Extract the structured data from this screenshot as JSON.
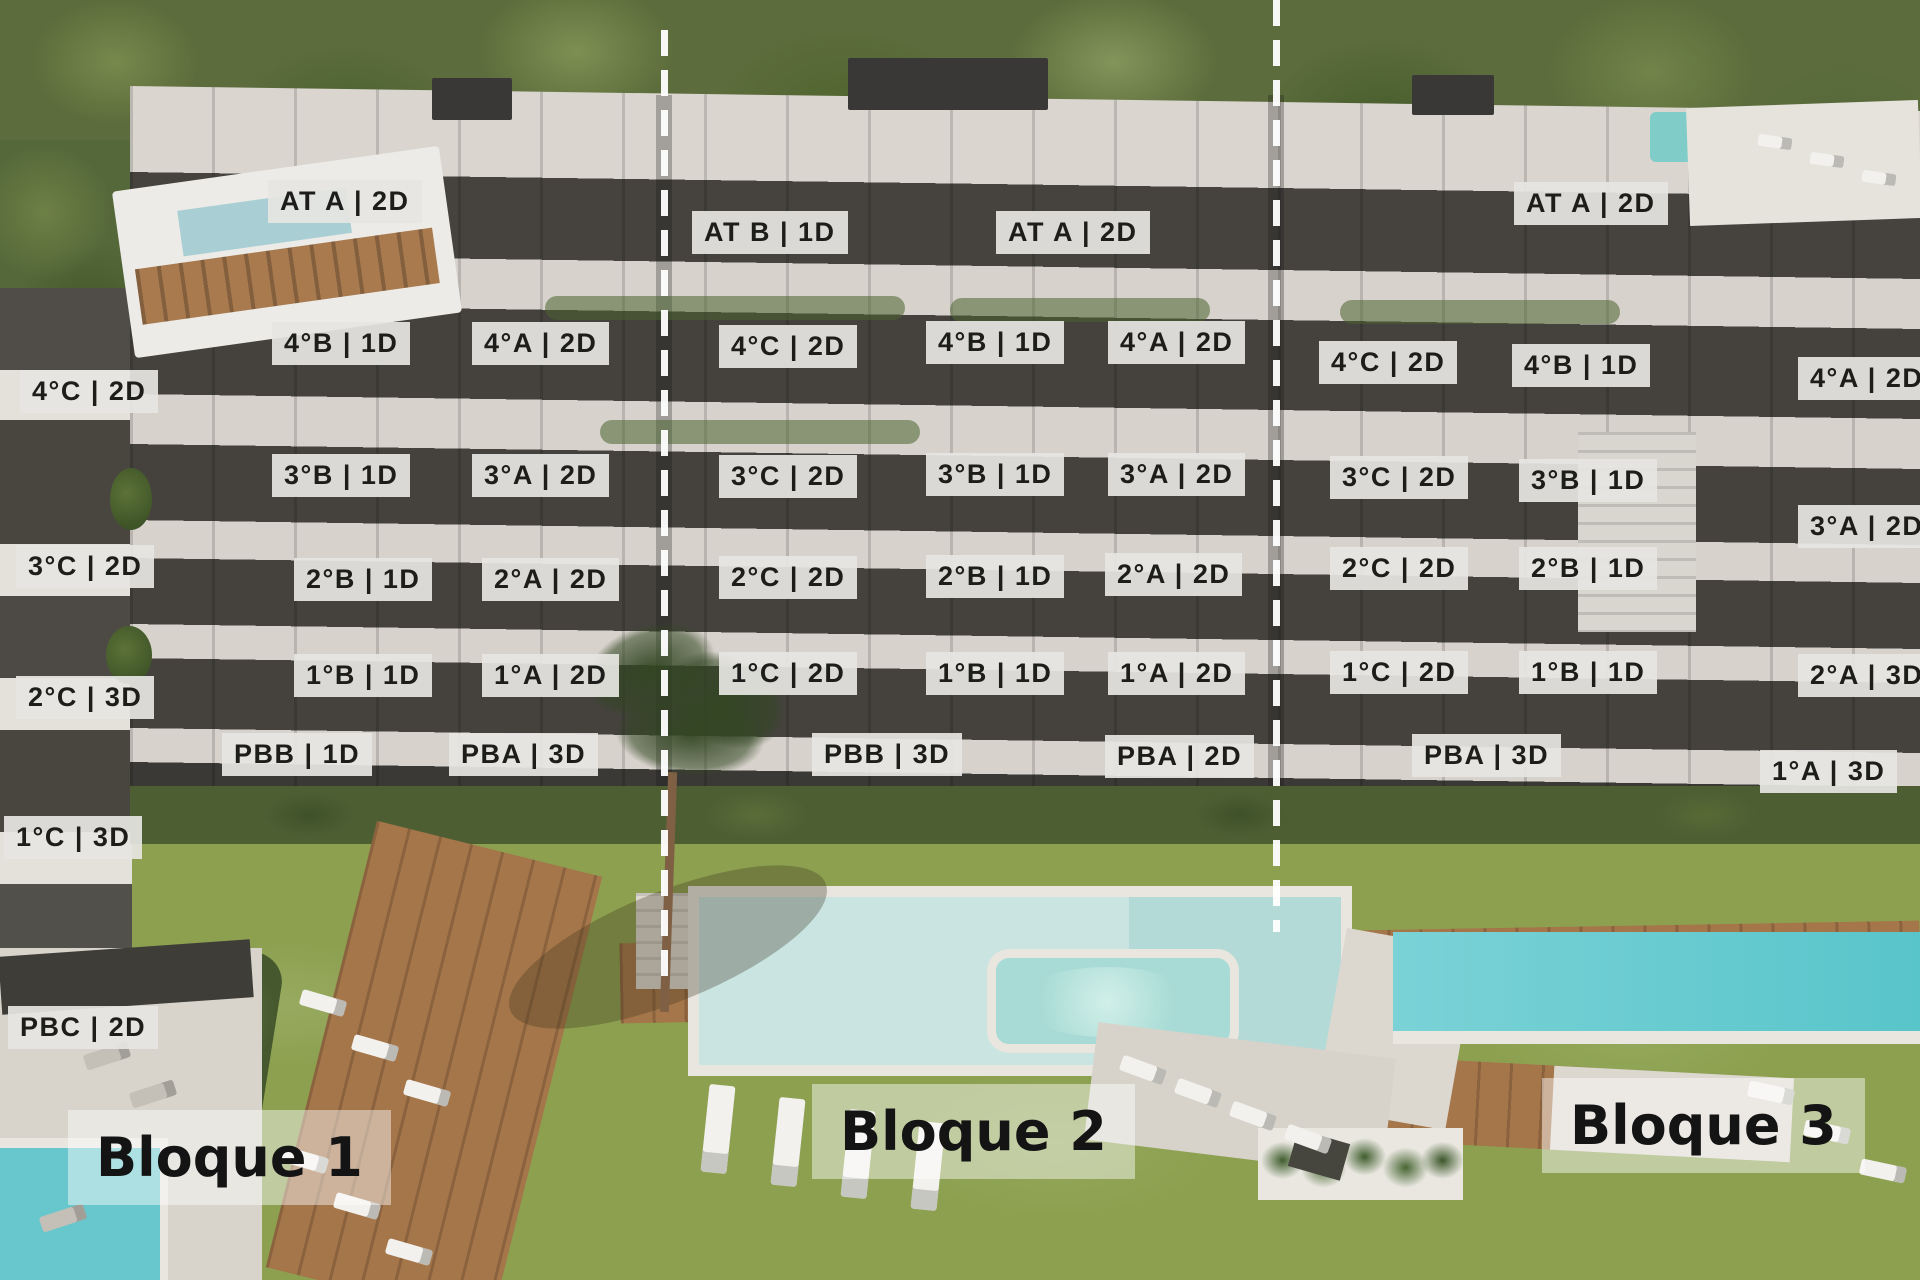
{
  "image_type": "apartment development aerial render with unit overlay labels",
  "colors": {
    "label_bg": "#e6e5e2",
    "label_text": "#1d1d1b",
    "bloque_band_bg": "rgba(255,255,255,0.45)",
    "divider": "#ffffff",
    "foliage": "#5c6c3c",
    "facade_light": "#d7d2cc",
    "facade_dark": "#45423e",
    "grass": "#8ca050",
    "wood_deck": "#a5764a",
    "pool_center": "#c9e4e1",
    "pool_right": "#6fced3",
    "jacuzzi": "#a8dbd5"
  },
  "blocks": [
    {
      "label": "Bloque 1",
      "units": [
        {
          "label": "AT A | 2D",
          "x": 268,
          "y": 180
        },
        {
          "label": "4°C | 2D",
          "x": 20,
          "y": 370
        },
        {
          "label": "4°B | 1D",
          "x": 272,
          "y": 322
        },
        {
          "label": "4°A | 2D",
          "x": 472,
          "y": 322
        },
        {
          "label": "3°C | 2D",
          "x": 16,
          "y": 545
        },
        {
          "label": "3°B | 1D",
          "x": 272,
          "y": 454
        },
        {
          "label": "3°A | 2D",
          "x": 472,
          "y": 454
        },
        {
          "label": "2°C | 3D",
          "x": 16,
          "y": 676
        },
        {
          "label": "2°B | 1D",
          "x": 294,
          "y": 558
        },
        {
          "label": "2°A | 2D",
          "x": 482,
          "y": 558
        },
        {
          "label": "1°C | 3D",
          "x": 4,
          "y": 816
        },
        {
          "label": "1°B | 1D",
          "x": 294,
          "y": 654
        },
        {
          "label": "1°A | 2D",
          "x": 482,
          "y": 654
        },
        {
          "label": "PBC | 2D",
          "x": 8,
          "y": 1006
        },
        {
          "label": "PBB | 1D",
          "x": 222,
          "y": 733
        },
        {
          "label": "PBA | 3D",
          "x": 449,
          "y": 733
        }
      ]
    },
    {
      "label": "Bloque 2",
      "units": [
        {
          "label": "AT B | 1D",
          "x": 692,
          "y": 211
        },
        {
          "label": "AT A | 2D",
          "x": 996,
          "y": 211
        },
        {
          "label": "4°C | 2D",
          "x": 719,
          "y": 325
        },
        {
          "label": "4°B | 1D",
          "x": 926,
          "y": 321
        },
        {
          "label": "4°A | 2D",
          "x": 1108,
          "y": 321
        },
        {
          "label": "3°C | 2D",
          "x": 719,
          "y": 455
        },
        {
          "label": "3°B | 1D",
          "x": 926,
          "y": 453
        },
        {
          "label": "3°A | 2D",
          "x": 1108,
          "y": 453
        },
        {
          "label": "2°C | 2D",
          "x": 719,
          "y": 556
        },
        {
          "label": "2°B | 1D",
          "x": 926,
          "y": 555
        },
        {
          "label": "2°A | 2D",
          "x": 1105,
          "y": 553
        },
        {
          "label": "1°C | 2D",
          "x": 719,
          "y": 652
        },
        {
          "label": "1°B | 1D",
          "x": 926,
          "y": 652
        },
        {
          "label": "1°A | 2D",
          "x": 1108,
          "y": 652
        },
        {
          "label": "PBB | 3D",
          "x": 812,
          "y": 733
        },
        {
          "label": "PBA | 2D",
          "x": 1105,
          "y": 735
        }
      ]
    },
    {
      "label": "Bloque 3",
      "units": [
        {
          "label": "AT A | 2D",
          "x": 1514,
          "y": 182
        },
        {
          "label": "4°C | 2D",
          "x": 1319,
          "y": 341
        },
        {
          "label": "4°B | 1D",
          "x": 1512,
          "y": 344
        },
        {
          "label": "4°A | 2D",
          "x": 1798,
          "y": 357
        },
        {
          "label": "3°C | 2D",
          "x": 1330,
          "y": 456
        },
        {
          "label": "3°B | 1D",
          "x": 1519,
          "y": 459
        },
        {
          "label": "3°A | 2D",
          "x": 1798,
          "y": 505
        },
        {
          "label": "2°C | 2D",
          "x": 1330,
          "y": 547
        },
        {
          "label": "2°B | 1D",
          "x": 1519,
          "y": 547
        },
        {
          "label": "2°A | 3D",
          "x": 1798,
          "y": 654
        },
        {
          "label": "1°C | 2D",
          "x": 1330,
          "y": 651
        },
        {
          "label": "1°B | 1D",
          "x": 1519,
          "y": 651
        },
        {
          "label": "1°A | 3D",
          "x": 1760,
          "y": 750
        },
        {
          "label": "PBA | 3D",
          "x": 1412,
          "y": 734
        }
      ]
    }
  ]
}
